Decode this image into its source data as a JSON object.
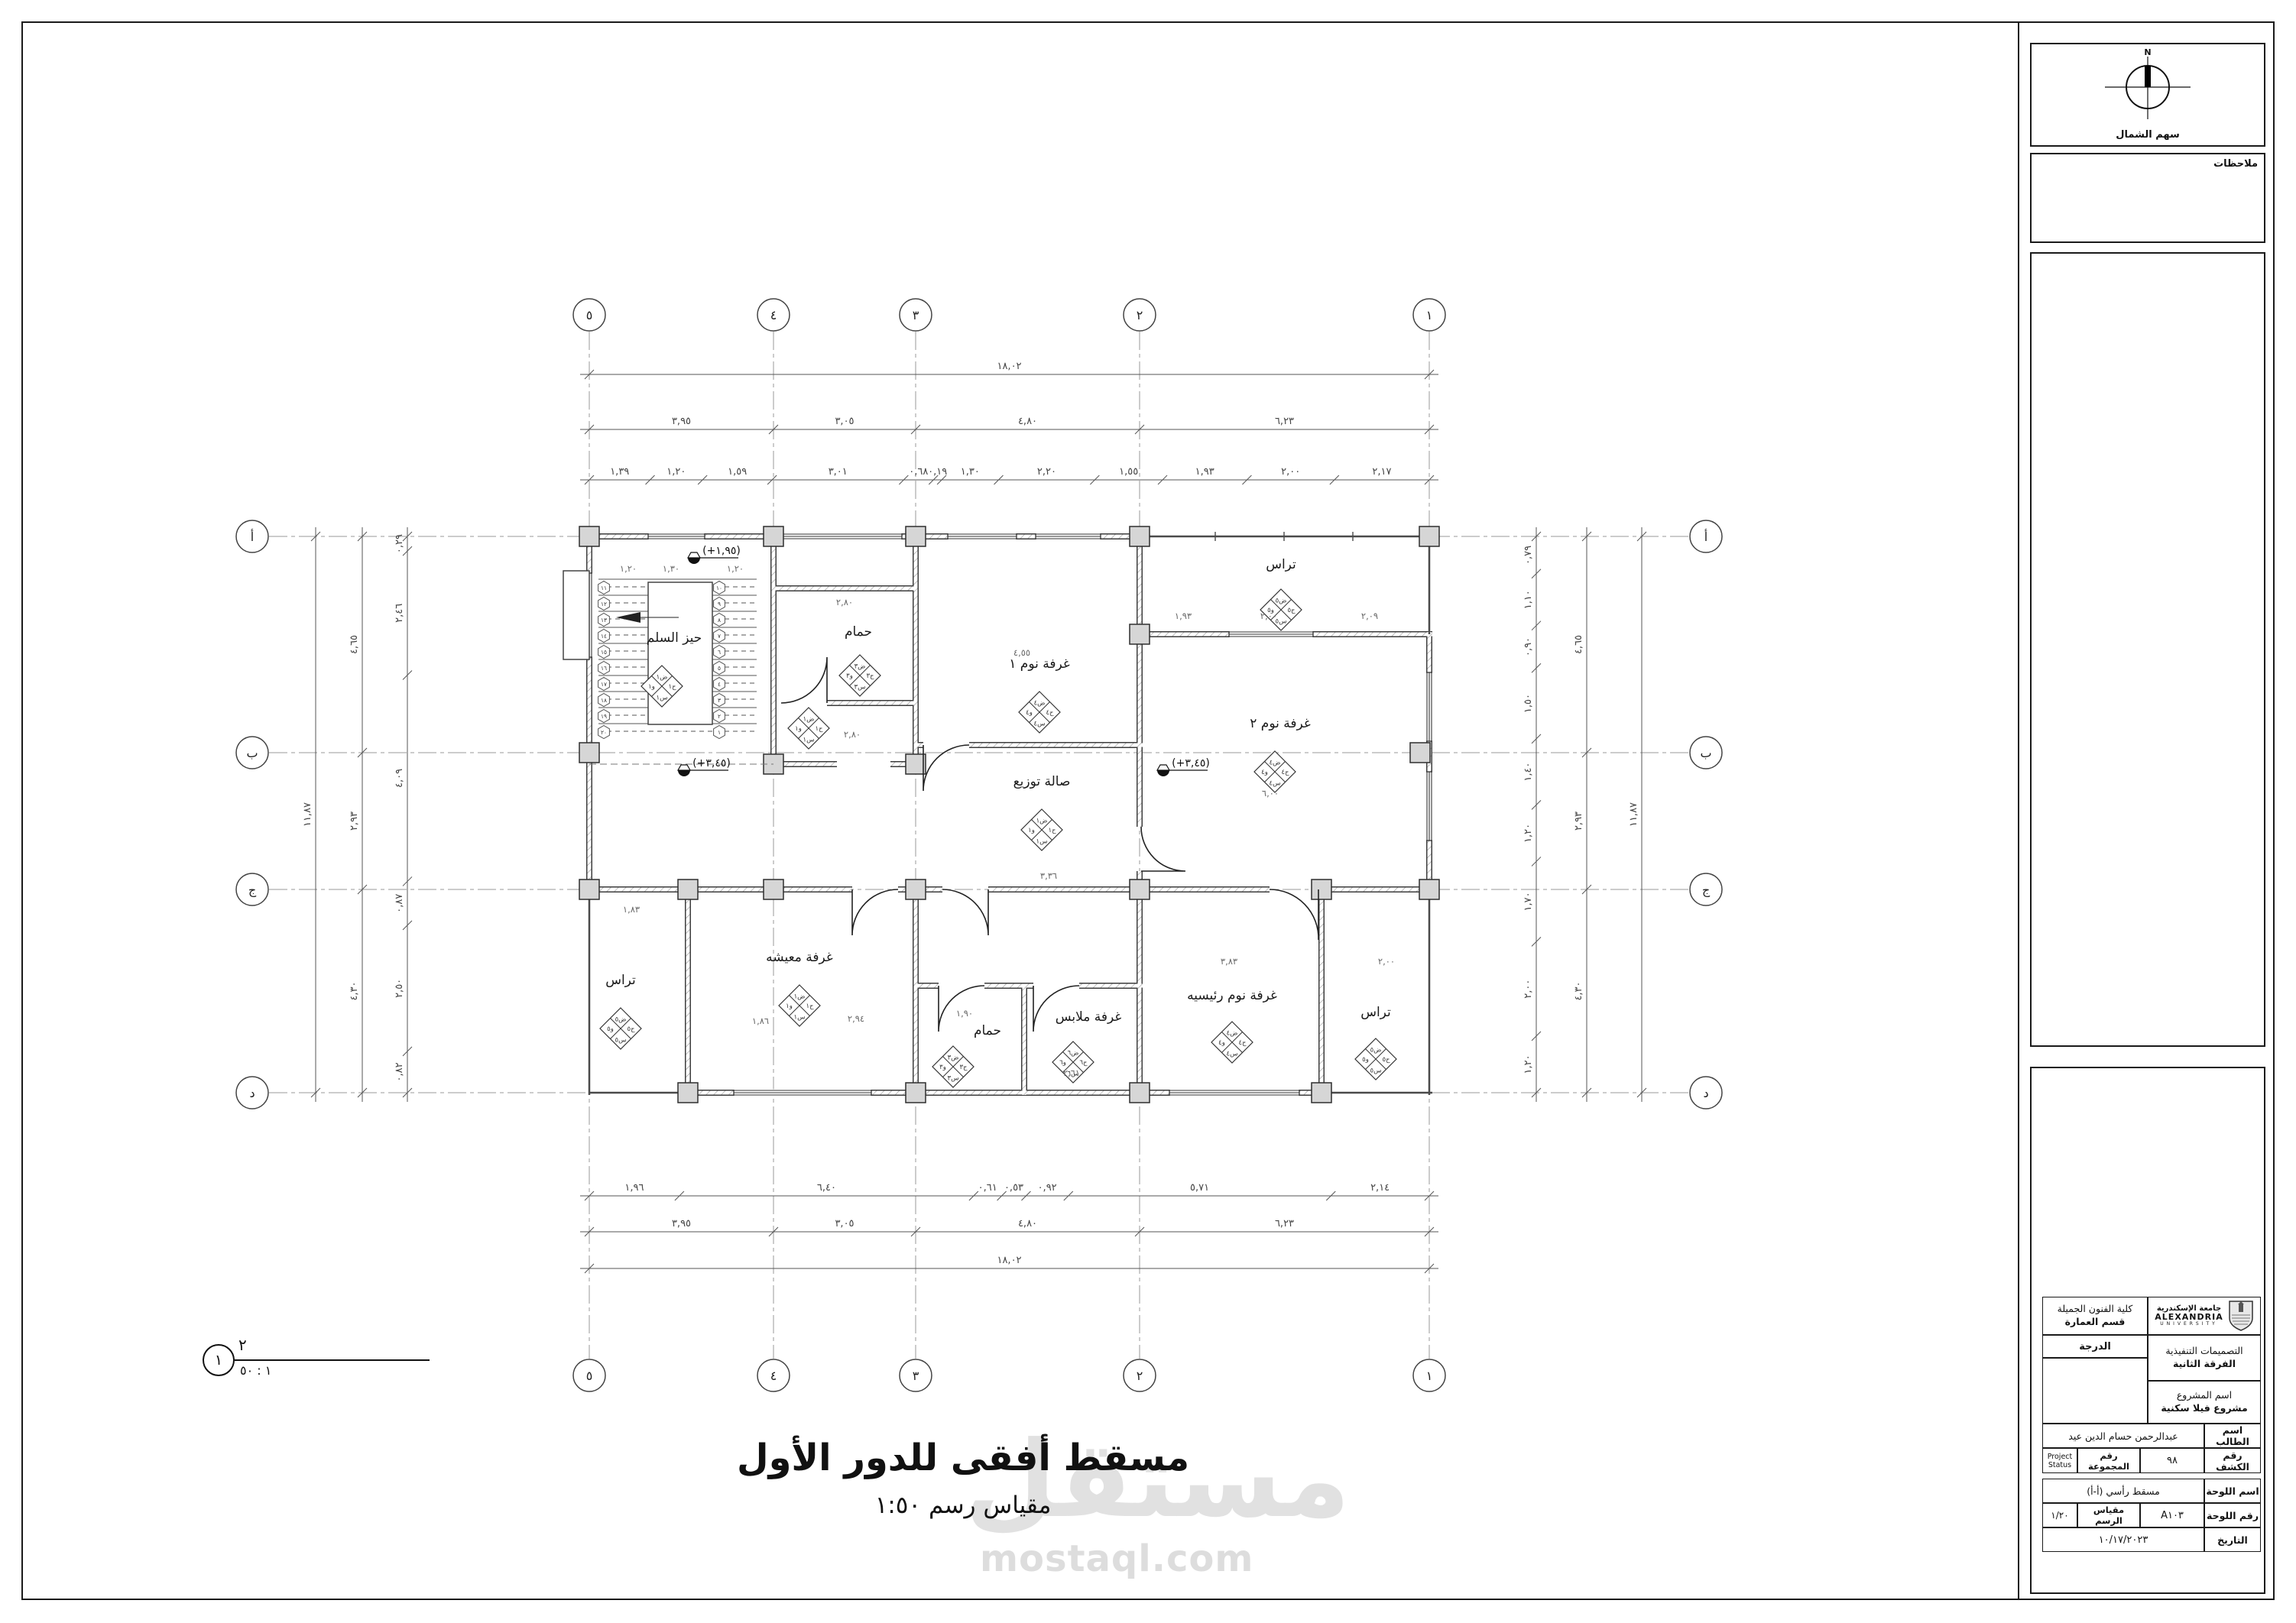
{
  "sheet": {
    "north_label": "سهم الشمال",
    "north_n": "N",
    "notes_label": "ملاحظات",
    "main_title": "مسقط أفقى للدور الأول",
    "scale_line": "مقياس رسم  ١:٥٠",
    "view_marker": {
      "number": "١",
      "top": "٢",
      "bottom": "١ : ٥٠"
    },
    "watermark": {
      "word": "مستقل",
      "domain": "mostaql.com"
    }
  },
  "title_block": {
    "faculty": "كلية الفنون الجميلة",
    "department": "قسم العمارة",
    "grade_label": "الدرجة",
    "course": "التصميمات التنفيذية",
    "year": "الفرقة الثانية",
    "project_label": "اسم المشروع",
    "project_name": "مشروع فيلا سكنية",
    "student_label": "اسم الطالب",
    "student_name": "عبدالرحمن حسام الدين عيد",
    "list_no_label": "رقم الكشف",
    "list_no": "٩٨",
    "group_label": "رقم المجموعة",
    "group_value": "Project Status",
    "sheet_name_label": "اسم اللوحة",
    "sheet_name": "مسقط رأسي (أ-أ)",
    "sheet_no_label": "رقم اللوحة",
    "sheet_no": "A١٠٣",
    "scale_label": "مقياس الرسم",
    "scale_value": "١/٢٠",
    "date_label": "التاريخ",
    "date_value": "١٠/١٧/٢٠٢٣",
    "university_ar": "جامعة الإسكندرية",
    "university_en": "ALEXANDRIA",
    "university_sub": "UNIVERSITY"
  },
  "grid": {
    "cols": [
      "٥",
      "٤",
      "٣",
      "٢",
      "١"
    ],
    "rows": [
      "أ",
      "ب",
      "ج",
      "د"
    ]
  },
  "dims": {
    "top_overall": "١٨,٠٢",
    "top_major": [
      "٣,٩٥",
      "٣,٠٥",
      "٤,٨٠",
      "٦,٢٣"
    ],
    "top_detail": [
      "١,٣٩",
      "١,٢٠",
      "١,٥٩",
      "٣,٠١",
      "٠,٦٨",
      "٠,١٩",
      "١,٣٠",
      "٢,٢٠",
      "١,٥٥",
      "١,٩٣",
      "٢,٠٠",
      "٢,١٧"
    ],
    "bottom_detail": [
      "١,٩٦",
      "٦,٤٠",
      "٠,٦١",
      "٠,٥٣",
      "٠,٩٢",
      "٥,٧١",
      "٢,١٤"
    ],
    "bottom_major": [
      "٣,٩٥",
      "٣,٠٥",
      "٤,٨٠",
      "٦,٢٣"
    ],
    "bottom_overall": "١٨,٠٢",
    "left_overall": "١١,٨٧",
    "left_major": [
      "٤,٦٥",
      "٢,٩٣",
      "٤,٣٠"
    ],
    "left_detail": [
      "٠,٢٩",
      "٢,٤٦",
      "٤,٠٩",
      "٠,٨٧",
      "٢,٥٠",
      "٠,٨٢"
    ],
    "right_detail": [
      "٠,٧٩",
      "١,١٠",
      "٠,٩٠",
      "١,٥٠",
      "١,٤٠",
      "١,٢٠",
      "١,٧٠",
      "٢,٠٠",
      "١,٢٠"
    ],
    "right_major": [
      "٤,٦٥",
      "٢,٩٣",
      "٤,٣٠"
    ],
    "right_overall": "١١,٨٧"
  },
  "plan": {
    "rooms": [
      {
        "name": "حيز السلم",
        "code": "١"
      },
      {
        "name": "حمام",
        "code": "٣"
      },
      {
        "name": "غرفة نوم ١",
        "code": "٤"
      },
      {
        "name": "تراس",
        "code": "٥"
      },
      {
        "name": "غرفة نوم ٢",
        "code": "٤"
      },
      {
        "name": "صالة توزيع",
        "code": "١"
      },
      {
        "name": "تراس",
        "code": "٥"
      },
      {
        "name": "غرفة معيشه",
        "code": "١"
      },
      {
        "name": "حمام",
        "code": "٣"
      },
      {
        "name": "غرفة ملابس",
        "code": "٦"
      },
      {
        "name": "غرفة نوم رئيسيه",
        "code": "٤"
      },
      {
        "name": "تراس",
        "code": "٥"
      },
      {
        "name": "",
        "code": "١"
      }
    ],
    "tag_prefixes": {
      "top": "ض",
      "right": "ح",
      "bottom": "س",
      "left": "و"
    },
    "levels": [
      "(+١,٩٥)",
      "(+٣,٤٥)",
      "(+٣,٤٥)"
    ],
    "inline_dims": [
      "١,٢٠",
      "١,٣٠",
      "١,٢٠",
      "٢,٨٠",
      "٤,٥٥",
      "١,٩٣",
      "٢,٠٠",
      "٢,٠٩",
      "٦,٠٠",
      "٢,٨٠",
      "٣,٣٦",
      "١,٨٣",
      "١,٨٦",
      "٢,٩٤",
      "١,٩٠",
      "٢,٦١",
      "٣,٨٣",
      "٢,٠٠"
    ],
    "stair_steps_right": [
      "١",
      "٢",
      "٣",
      "٤",
      "٥",
      "٦",
      "٧",
      "٨",
      "٩",
      "١٠"
    ],
    "stair_steps_left": [
      "١١",
      "١٢",
      "١٣",
      "١٤",
      "١٥",
      "١٦",
      "١٧",
      "١٨",
      "١٩",
      "٢٠"
    ]
  }
}
